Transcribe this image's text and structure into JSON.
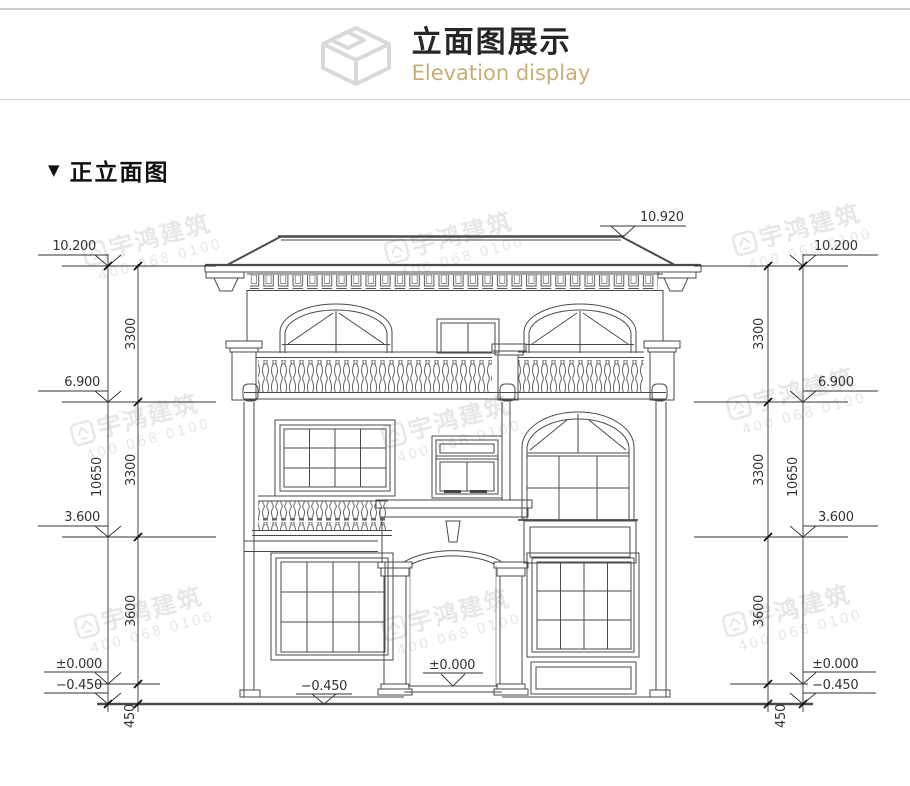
{
  "header": {
    "title": "立面图展示",
    "subtitle": "Elevation display",
    "icon": "isometric-box-icon"
  },
  "section": {
    "marker": "▼",
    "title": "正立面图"
  },
  "watermark": {
    "brand": "宇鸿建筑",
    "phone": "400 068 0100"
  },
  "dims": {
    "ridge": "10.920",
    "levels": [
      "10.200",
      "6.900",
      "3.600",
      "±0.000",
      "−0.450"
    ],
    "chain": [
      "3300",
      "3300",
      "3600",
      "450"
    ],
    "overall": "10650"
  },
  "colors": {
    "accent": "#c7ae74",
    "line": "#4a4a4a",
    "dim_text": "#333333",
    "watermark": "#e7e7e7",
    "rule": "#cfcfcf"
  }
}
